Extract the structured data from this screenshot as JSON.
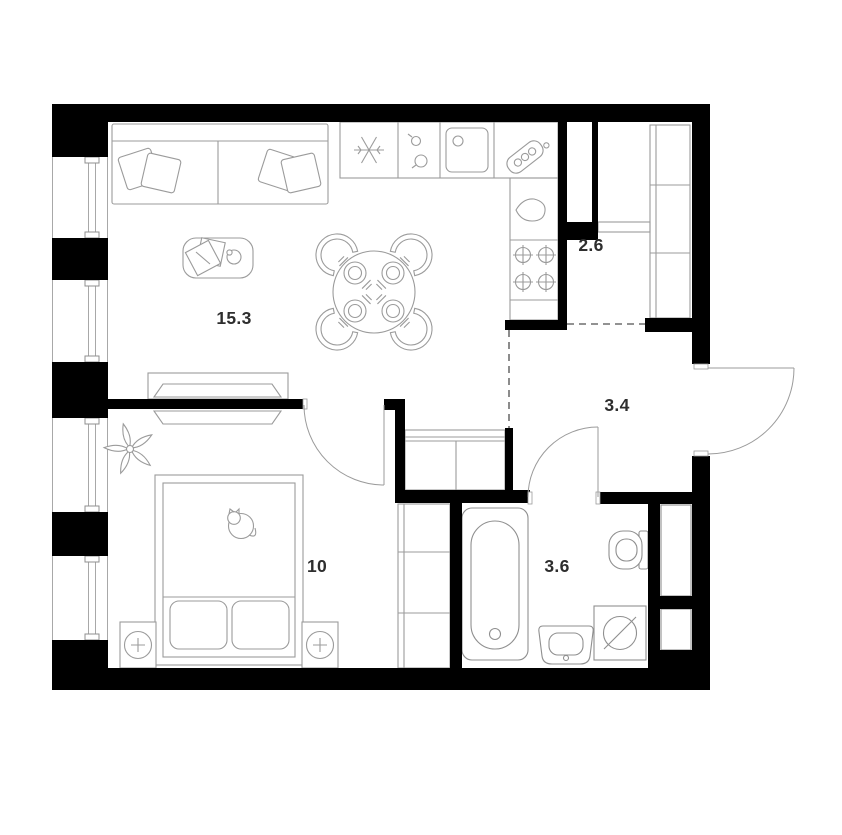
{
  "plan": {
    "background": "#ffffff",
    "wall_color": "#000000",
    "furniture_line_color": "#9b9b9b",
    "label_color": "#2e2e2e",
    "rooms": [
      {
        "name": "living-room-with-kitchen",
        "area": "15.3"
      },
      {
        "name": "storage-closet",
        "area": "2.6"
      },
      {
        "name": "hallway",
        "area": "3.4"
      },
      {
        "name": "bedroom",
        "area": "10"
      },
      {
        "name": "bathroom",
        "area": "3.6"
      }
    ],
    "furniture_icons": [
      "sofa-icon",
      "pillow-icon",
      "coffee-table-icon",
      "dining-table-icon",
      "chair-icon",
      "plate-with-cutlery-icon",
      "fridge-snowflake-icon",
      "hob-knobs-icon",
      "kitchen-sink-icon",
      "coffee-machine-icon",
      "kettle-drop-icon",
      "stove-burners-icon",
      "shelving-icon",
      "hall-closet-icon",
      "tv-console-icon",
      "tv-icon",
      "plant-icon",
      "bed-icon",
      "cat-icon",
      "nightstand-lamp-icon",
      "wardrobe-icon",
      "bathtub-icon",
      "toilet-icon",
      "wash-basin-icon",
      "washing-machine-icon",
      "vent-shaft-icon",
      "entrance-door-icon",
      "interior-door-icon",
      "window-icon"
    ]
  }
}
